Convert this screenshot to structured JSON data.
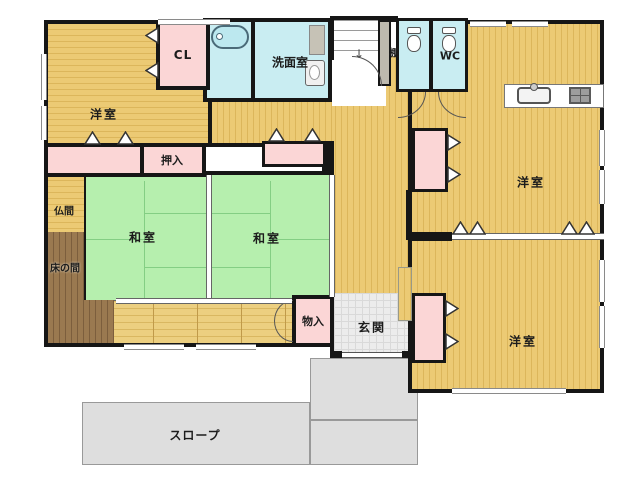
{
  "title": "floor-plan",
  "rooms": {
    "western_top_left": "洋室",
    "closet_cl": "CL",
    "washroom": "洗面室",
    "shelf": "棚",
    "toilet": "WC",
    "western_right": "洋室",
    "oshiire_closet": "押入",
    "butsuma": "仏間",
    "washitsu_left": "和室",
    "washitsu_right": "和室",
    "tokonoma": "床の間",
    "storage": "物入",
    "entrance": "玄関",
    "western_bottom_right": "洋室",
    "ramp": "スロープ"
  },
  "icons": {
    "stairs_down_arrow": "↓"
  },
  "colors": {
    "wall": "#161616",
    "wood_floor": "#ecca74",
    "tatami_green": "#b6efae",
    "closet_pink": "#fbd6d6",
    "water_cyan": "#c9edf2",
    "tokonoma_brown": "#9a7950",
    "porch_gray": "#dedede",
    "entrance_gray": "#ececec"
  }
}
